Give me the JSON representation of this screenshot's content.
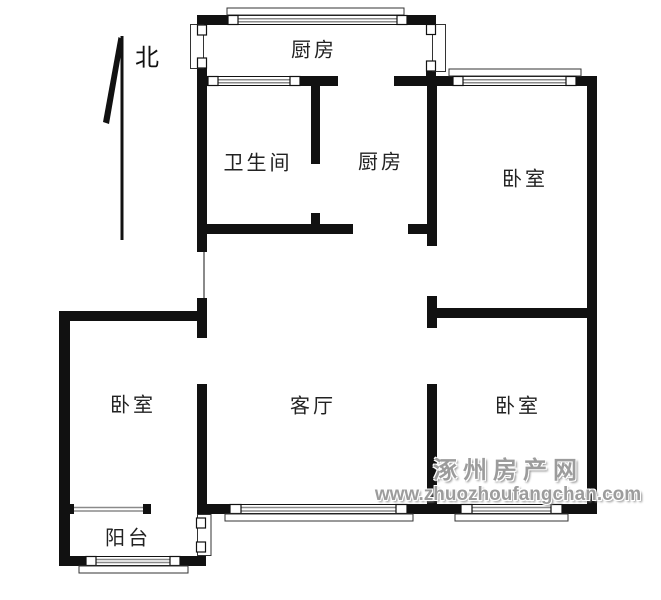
{
  "page": {
    "background": "#ffffff",
    "width": 661,
    "height": 600
  },
  "compass": {
    "label": "北",
    "direction_icon": "north-arrow"
  },
  "rooms": [
    {
      "id": "kitchen-north",
      "label": "厨房"
    },
    {
      "id": "bathroom",
      "label": "卫生间"
    },
    {
      "id": "kitchen-middle",
      "label": "厨房"
    },
    {
      "id": "bedroom-northeast",
      "label": "卧室"
    },
    {
      "id": "bedroom-west",
      "label": "卧室"
    },
    {
      "id": "living-room",
      "label": "客厅"
    },
    {
      "id": "bedroom-southeast",
      "label": "卧室"
    },
    {
      "id": "balcony",
      "label": "阳台"
    }
  ],
  "watermark": {
    "site_name": "涿州房产网",
    "site_url": "www.zhuozhoufangchan.com"
  },
  "colors": {
    "wall": "#111111",
    "window_line": "#8a8a8a",
    "frame_outline": "#333333",
    "watermark_text": "#9c9c9c",
    "label_text": "#222222"
  }
}
